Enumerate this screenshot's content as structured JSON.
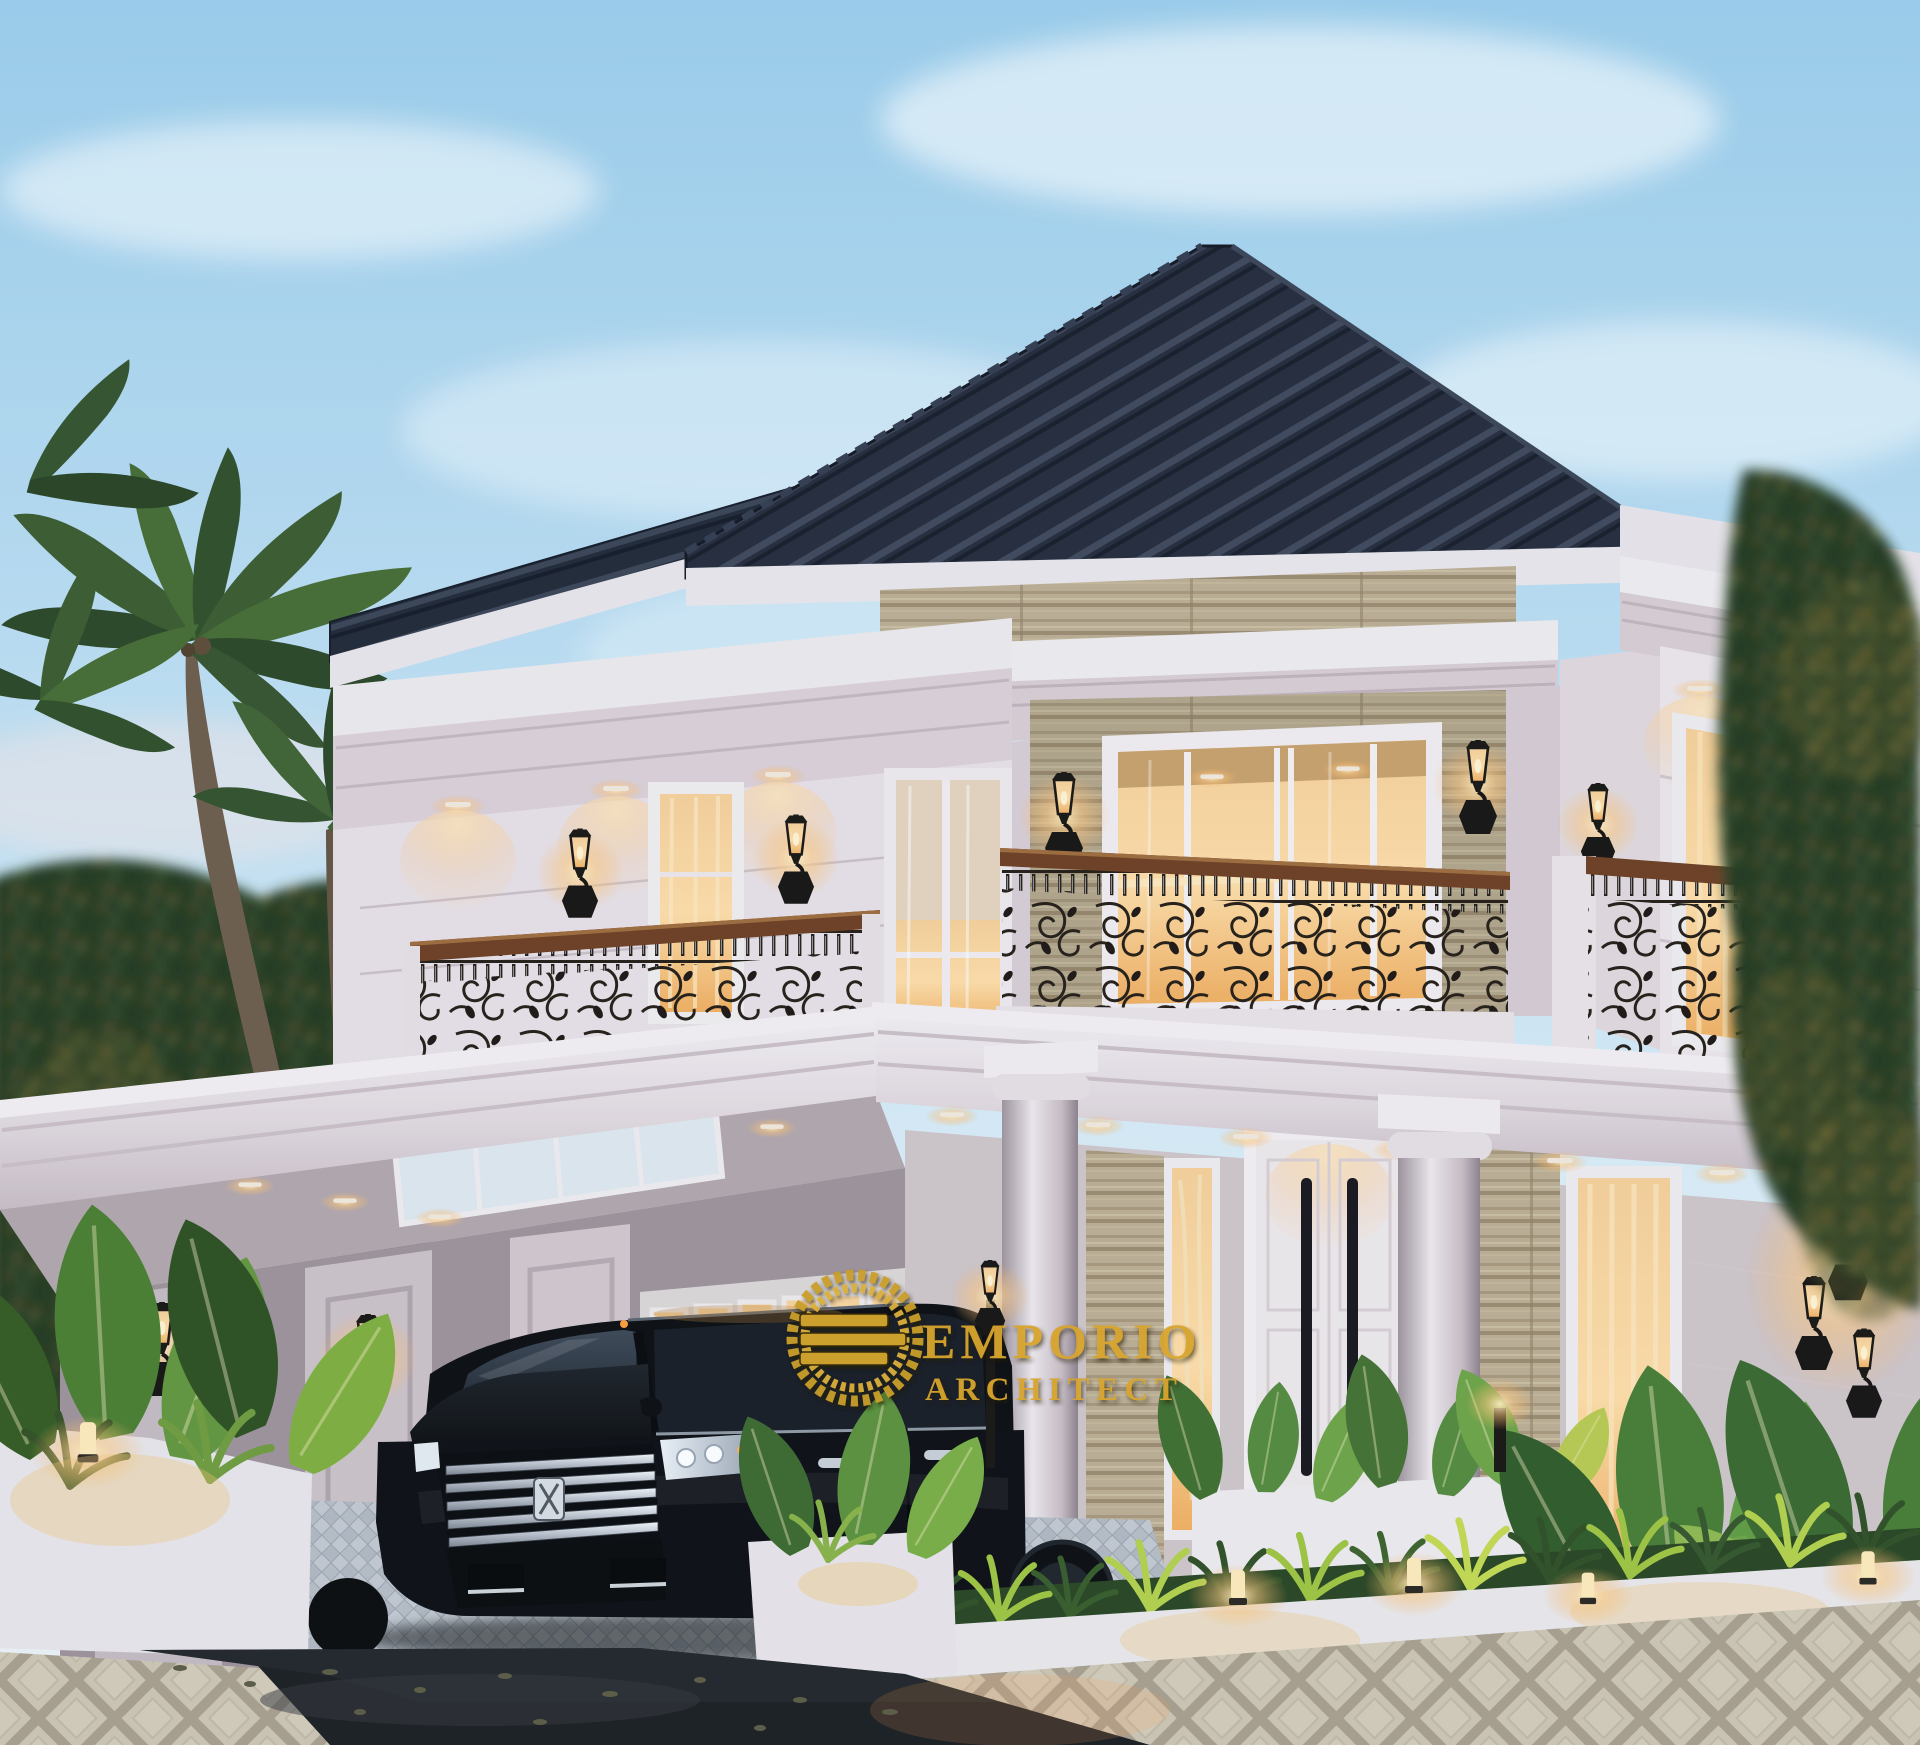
{
  "title": "Classic two-story villa exterior 3D rendering at dusk",
  "watermark": {
    "line1": "EMPORIO",
    "line2": "ARCHITECT",
    "gold": "#D4A62F"
  },
  "colors": {
    "sky_top": "#9CCEEB",
    "sky_horizon": "#E8F2F8",
    "roof_tile": "#212735",
    "wall_white": "#EDE6EA",
    "wall_shadow": "#D8CBD2",
    "stone_travertine": "#B7A78B",
    "warm_light": "#FFD092",
    "iron_railing": "#241B14",
    "wood_handrail": "#6E3D20",
    "foliage_dark": "#22351D",
    "foliage_gold": "#C9A43E",
    "asphalt": "#1A1C1F",
    "paver": "#C3C8CF",
    "walk_tile": "#D8D1C5"
  },
  "scene": {
    "setting": "luxury tropical villa, two floors, hipped dark roof, white classical mouldings",
    "features": [
      "wrought-iron balcony railings with wood handrail",
      "travertine stone accent walls",
      "black lantern wall sconces",
      "recessed warm downlights",
      "carport with skylight and garage door",
      "black luxury minivan parked in carport",
      "tropical garden with planters and bollard lights",
      "palm trees at left, hedge at right",
      "wet asphalt road and patterned tile walkway in foreground"
    ],
    "time_of_day": "dusk"
  }
}
